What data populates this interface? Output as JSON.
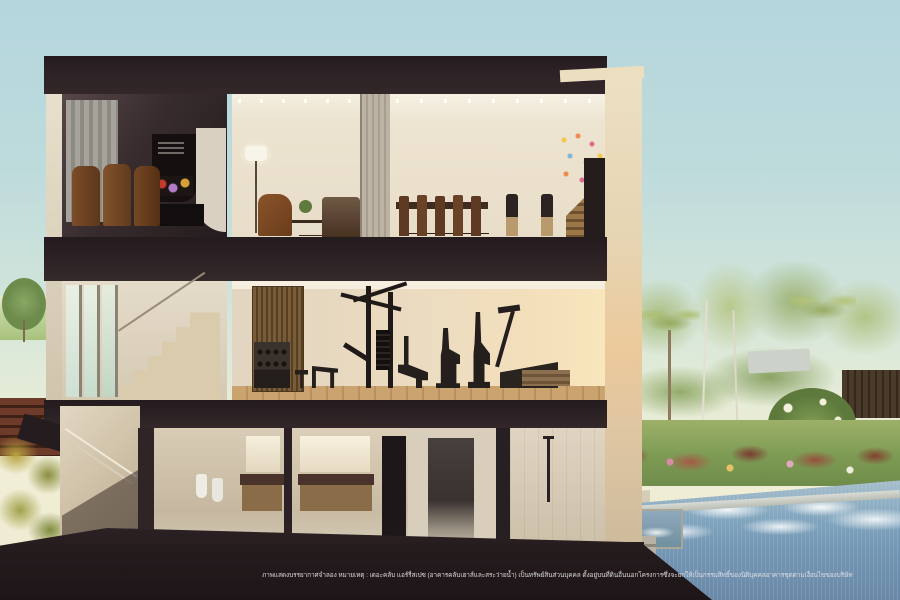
{
  "scene": {
    "kind": "3d-architectural-cutaway-render",
    "caption": "ภาพแสดงบรรยากาศจำลอง หมายเหตุ : เดอะคลับ แอร์รี่สเปซ (อาคารคลับเฮาส์และสระว่ายน้ำ) เป็นทรัพย์สินส่วนบุคคล ตั้งอยู่บนที่ดินอื่นนอกโครงการซึ่งจะยกให้เป็นกรรมสิทธิ์ของนิติบุคคลอาคารชุดตามเงื่อนไขของบริษัท"
  },
  "colors": {
    "sky_top": "#b4d6dd",
    "sky_horizon": "#f0eed6",
    "structure_dark": "#2a2124",
    "interior_cream": "#e9e0cf",
    "gym_glow": "#f6e2ba",
    "wood_slat": "#7b5c3a",
    "pool_blue": "#7396b4",
    "foliage_green": "#9cb068",
    "shrub_red": "#8a4436",
    "caption_text": "#e4e4e4"
  }
}
